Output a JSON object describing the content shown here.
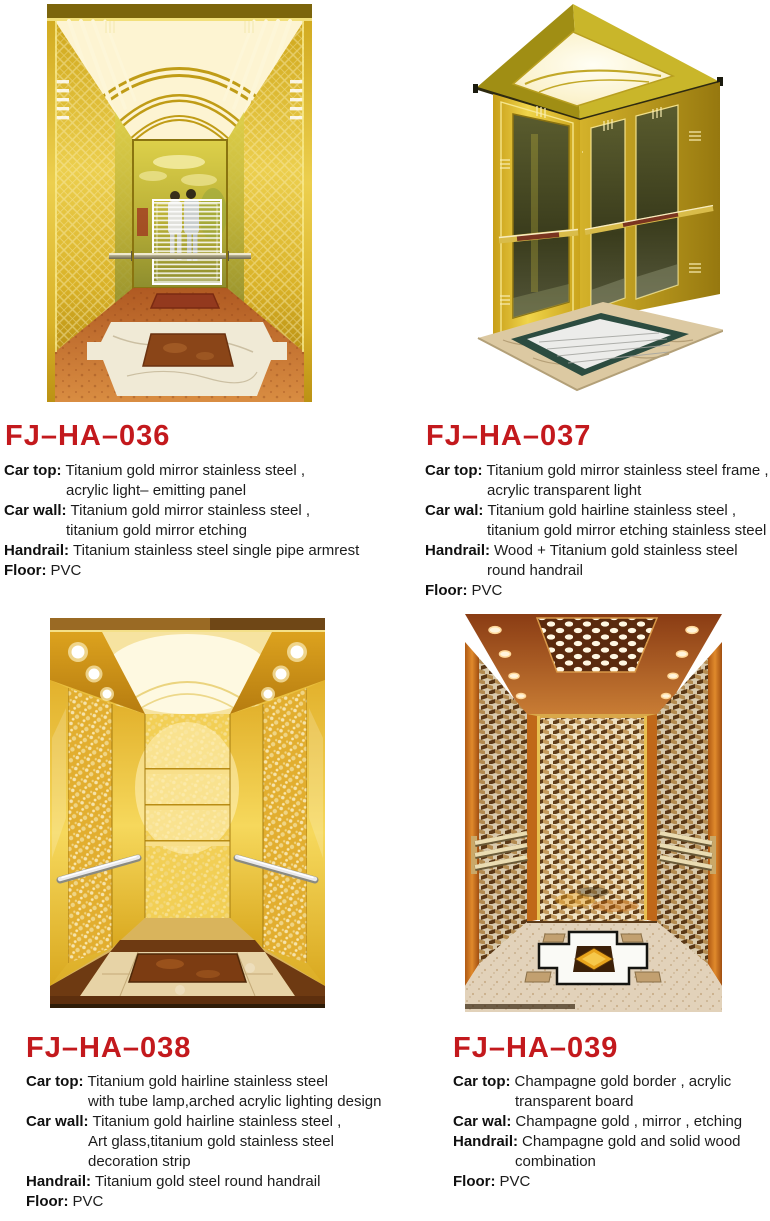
{
  "colors": {
    "title_red": "#c3191d",
    "text_black": "#1c1c1c",
    "background": "#ffffff",
    "gold_accent": "#e8c23a"
  },
  "products": [
    {
      "code": "FJ–HA–036",
      "specs": [
        {
          "label": "Car top:",
          "text": "Titanium gold mirror stainless steel ,",
          "cont": [
            "acrylic light– emitting panel"
          ]
        },
        {
          "label": "Car wall:",
          "text": "Titanium gold mirror stainless steel ,",
          "cont": [
            "titanium gold mirror etching"
          ]
        },
        {
          "label": "Handrail:",
          "text": "Titanium stainless steel single pipe armrest",
          "cont": []
        },
        {
          "label": "Floor:",
          "text": "PVC",
          "cont": []
        }
      ]
    },
    {
      "code": "FJ–HA–037",
      "specs": [
        {
          "label": "Car top:",
          "text": "Titanium gold mirror stainless steel frame ,",
          "cont": [
            "acrylic transparent light"
          ]
        },
        {
          "label": "Car wal:",
          "text": "Titanium gold hairline stainless steel ,",
          "cont": [
            "titanium gold mirror etching stainless steel"
          ]
        },
        {
          "label": "Handrail:",
          "text": "Wood + Titanium gold stainless steel",
          "cont": [
            "round handrail"
          ]
        },
        {
          "label": "Floor:",
          "text": "PVC",
          "cont": []
        }
      ]
    },
    {
      "code": "FJ–HA–038",
      "specs": [
        {
          "label": "Car top:",
          "text": "Titanium gold hairline stainless steel",
          "cont": [
            "with tube lamp,arched acrylic lighting design"
          ]
        },
        {
          "label": "Car wall:",
          "text": "Titanium gold hairline stainless steel ,",
          "cont": [
            "Art glass,titanium gold stainless steel",
            "decoration strip"
          ]
        },
        {
          "label": "Handrail:",
          "text": "Titanium gold steel round handrail",
          "cont": []
        },
        {
          "label": "Floor:",
          "text": "PVC",
          "cont": []
        }
      ]
    },
    {
      "code": "FJ–HA–039",
      "specs": [
        {
          "label": "Car top:",
          "text": "Champagne gold border , acrylic",
          "cont": [
            "transparent board"
          ]
        },
        {
          "label": "Car wal:",
          "text": "Champagne gold , mirror , etching",
          "cont": []
        },
        {
          "label": "Handrail:",
          "text": "Champagne gold and solid wood",
          "cont": [
            "combination"
          ]
        },
        {
          "label": "Floor:",
          "text": "PVC",
          "cont": []
        }
      ]
    }
  ]
}
